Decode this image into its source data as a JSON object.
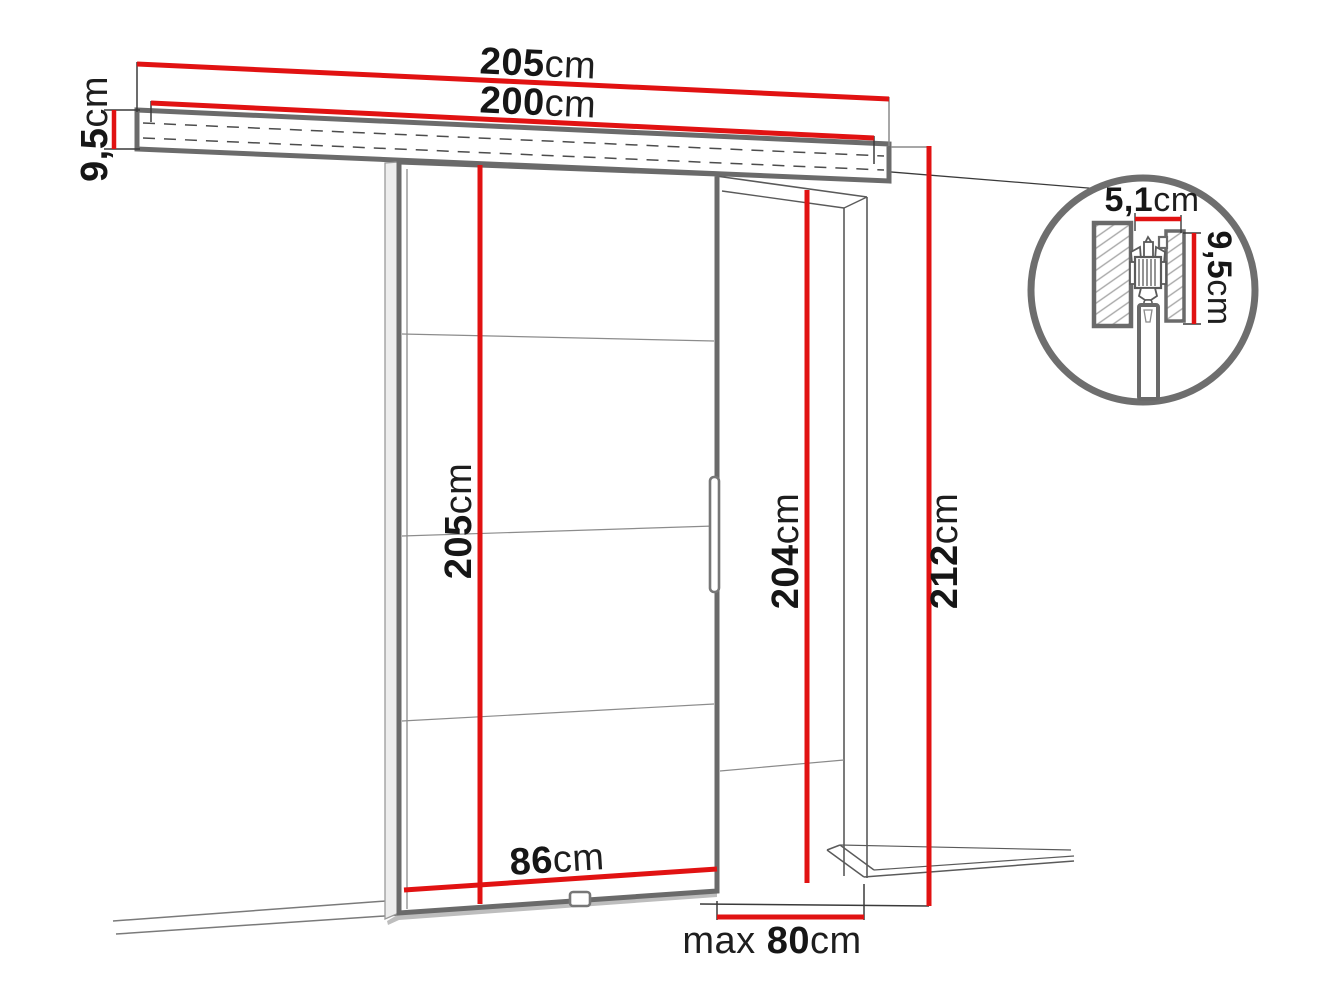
{
  "diagram": {
    "title": "Sliding door system dimension drawing",
    "unit": "cm",
    "colors": {
      "dimension_red": "#e11212",
      "structure_gray": "#6a6a6a",
      "text": "#161616"
    },
    "dimensions": {
      "track_total_width": {
        "value": "205",
        "unit": "cm"
      },
      "track_length": {
        "value": "200",
        "unit": "cm"
      },
      "track_height": {
        "value": "9,5",
        "unit": "cm"
      },
      "door_height": {
        "value": "205",
        "unit": "cm"
      },
      "door_width": {
        "value": "86",
        "unit": "cm"
      },
      "opening_height": {
        "value": "204",
        "unit": "cm"
      },
      "total_height": {
        "value": "212",
        "unit": "cm"
      },
      "opening_max_width": {
        "prefix": "max ",
        "value": "80",
        "unit": "cm"
      },
      "detail_track_width": {
        "value": "5,1",
        "unit": "cm"
      },
      "detail_track_height": {
        "value": "9,5",
        "unit": "cm"
      }
    }
  }
}
